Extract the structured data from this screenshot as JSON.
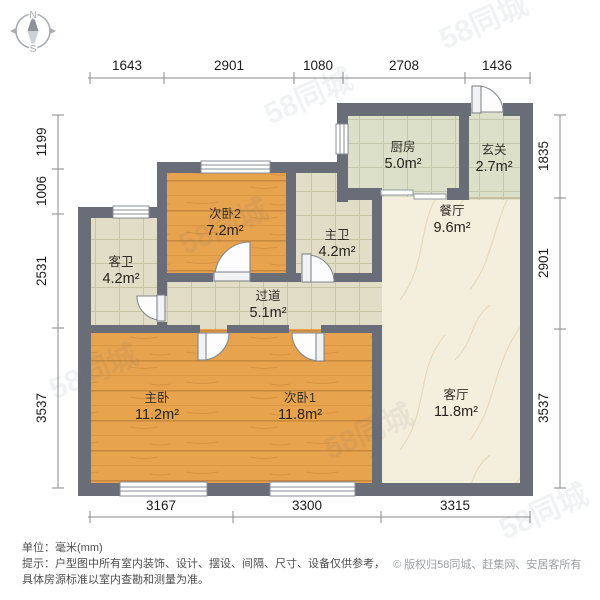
{
  "compass": {
    "north": "N",
    "south": "S"
  },
  "dimensions": {
    "top": [
      "1643",
      "2901",
      "1080",
      "2708",
      "1436"
    ],
    "left": [
      "1199",
      "1006",
      "2531",
      "3537"
    ],
    "right": [
      "1835",
      "2901",
      "3537"
    ],
    "bottom": [
      "3167",
      "3300",
      "3315"
    ]
  },
  "rooms": {
    "kitchen": {
      "name": "厨房",
      "area": "5.0m²"
    },
    "entry": {
      "name": "玄关",
      "area": "2.7m²"
    },
    "bedroom2": {
      "name": "次卧2",
      "area": "7.2m²"
    },
    "guest_bath": {
      "name": "客卫",
      "area": "4.2m²"
    },
    "master_bath": {
      "name": "主卫",
      "area": "4.2m²"
    },
    "hallway": {
      "name": "过道",
      "area": "5.1m²"
    },
    "dining": {
      "name": "餐厅",
      "area": "9.6m²"
    },
    "living": {
      "name": "客厅",
      "area": "11.8m²"
    },
    "master_bedroom": {
      "name": "主卧",
      "area": "11.2m²"
    },
    "bedroom1": {
      "name": "次卧1",
      "area": "11.8m²"
    }
  },
  "footer": {
    "unit": "单位：毫米(mm)",
    "tip": "提示：户型图中所有室内装饰、设计、摆设、间隔、尺寸、设备仅供参考，",
    "tip2": "具体房源标准以室内查勘和测量为准。",
    "copyright": "© 版权归58同城、赶集网、安居客所有"
  },
  "watermark": "58同城",
  "colors": {
    "wall": "#696d77",
    "wood": "#e7a34e",
    "tile_green": "#dde0c9",
    "tile_beige": "#e2ddc6",
    "marble": "#f4eedc"
  }
}
